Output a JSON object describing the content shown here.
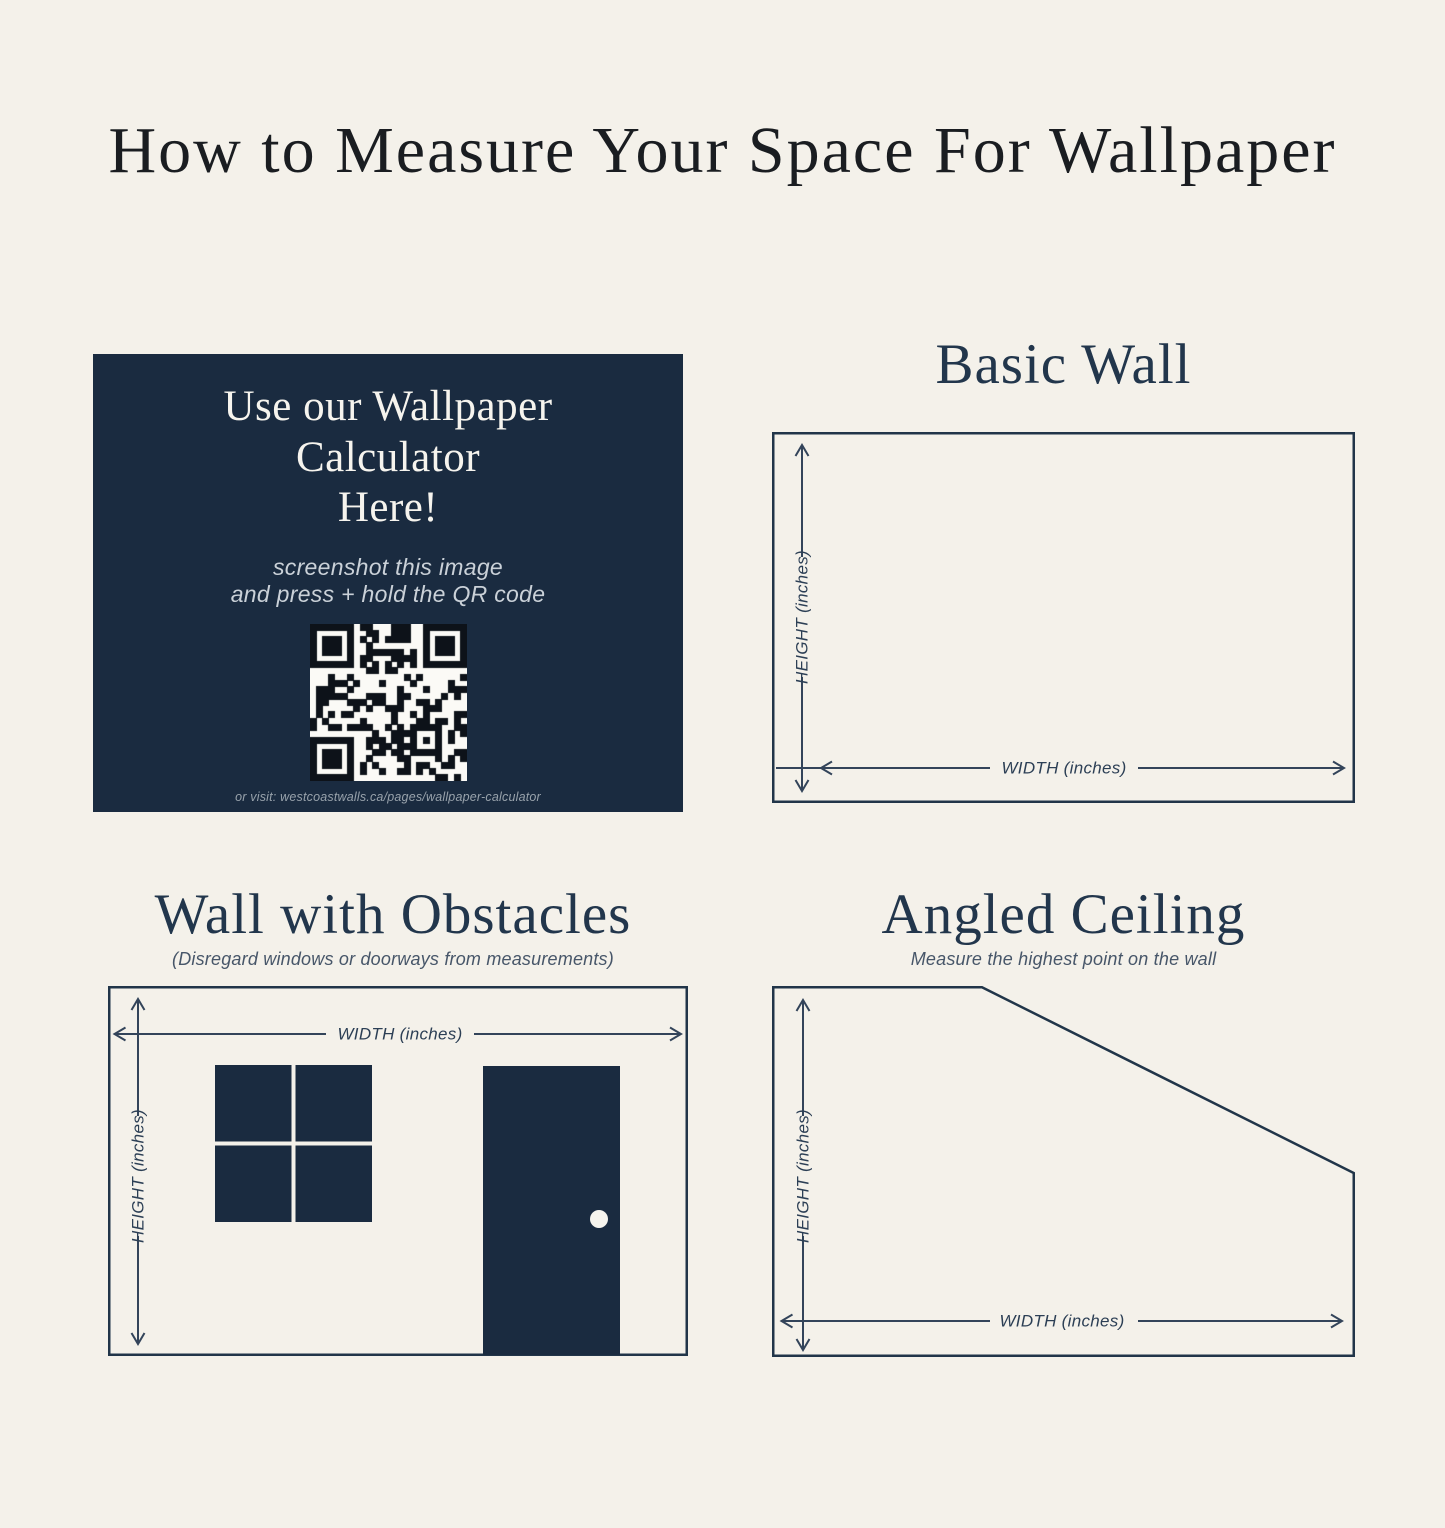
{
  "page": {
    "title": "How to Measure Your Space For Wallpaper"
  },
  "calculator_card": {
    "heading_lines": [
      "Use our Wallpaper",
      "Calculator",
      "Here!"
    ],
    "instruction_lines": [
      "screenshot this image",
      "and press + hold the QR code"
    ],
    "url_caption": "or visit: westcoastwalls.ca/pages/wallpaper-calculator",
    "qr_alt": "qr-code"
  },
  "diagrams": {
    "basic_wall": {
      "title": "Basic Wall",
      "height_label": "HEIGHT (inches)",
      "width_label": "WIDTH (inches)"
    },
    "wall_with_obstacles": {
      "title": "Wall with Obstacles",
      "subtitle": "(Disregard windows or doorways from measurements)",
      "height_label": "HEIGHT (inches)",
      "width_label": "WIDTH (inches)"
    },
    "angled_ceiling": {
      "title": "Angled Ceiling",
      "subtitle": "Measure the highest point on the wall",
      "height_label": "HEIGHT (inches)",
      "width_label": "WIDTH (inches)"
    }
  },
  "colors": {
    "background": "#f4f1ea",
    "navy": "#1a2b40",
    "line": "#33445a",
    "section_title": "#22364c",
    "main_title": "#1a1d21"
  }
}
